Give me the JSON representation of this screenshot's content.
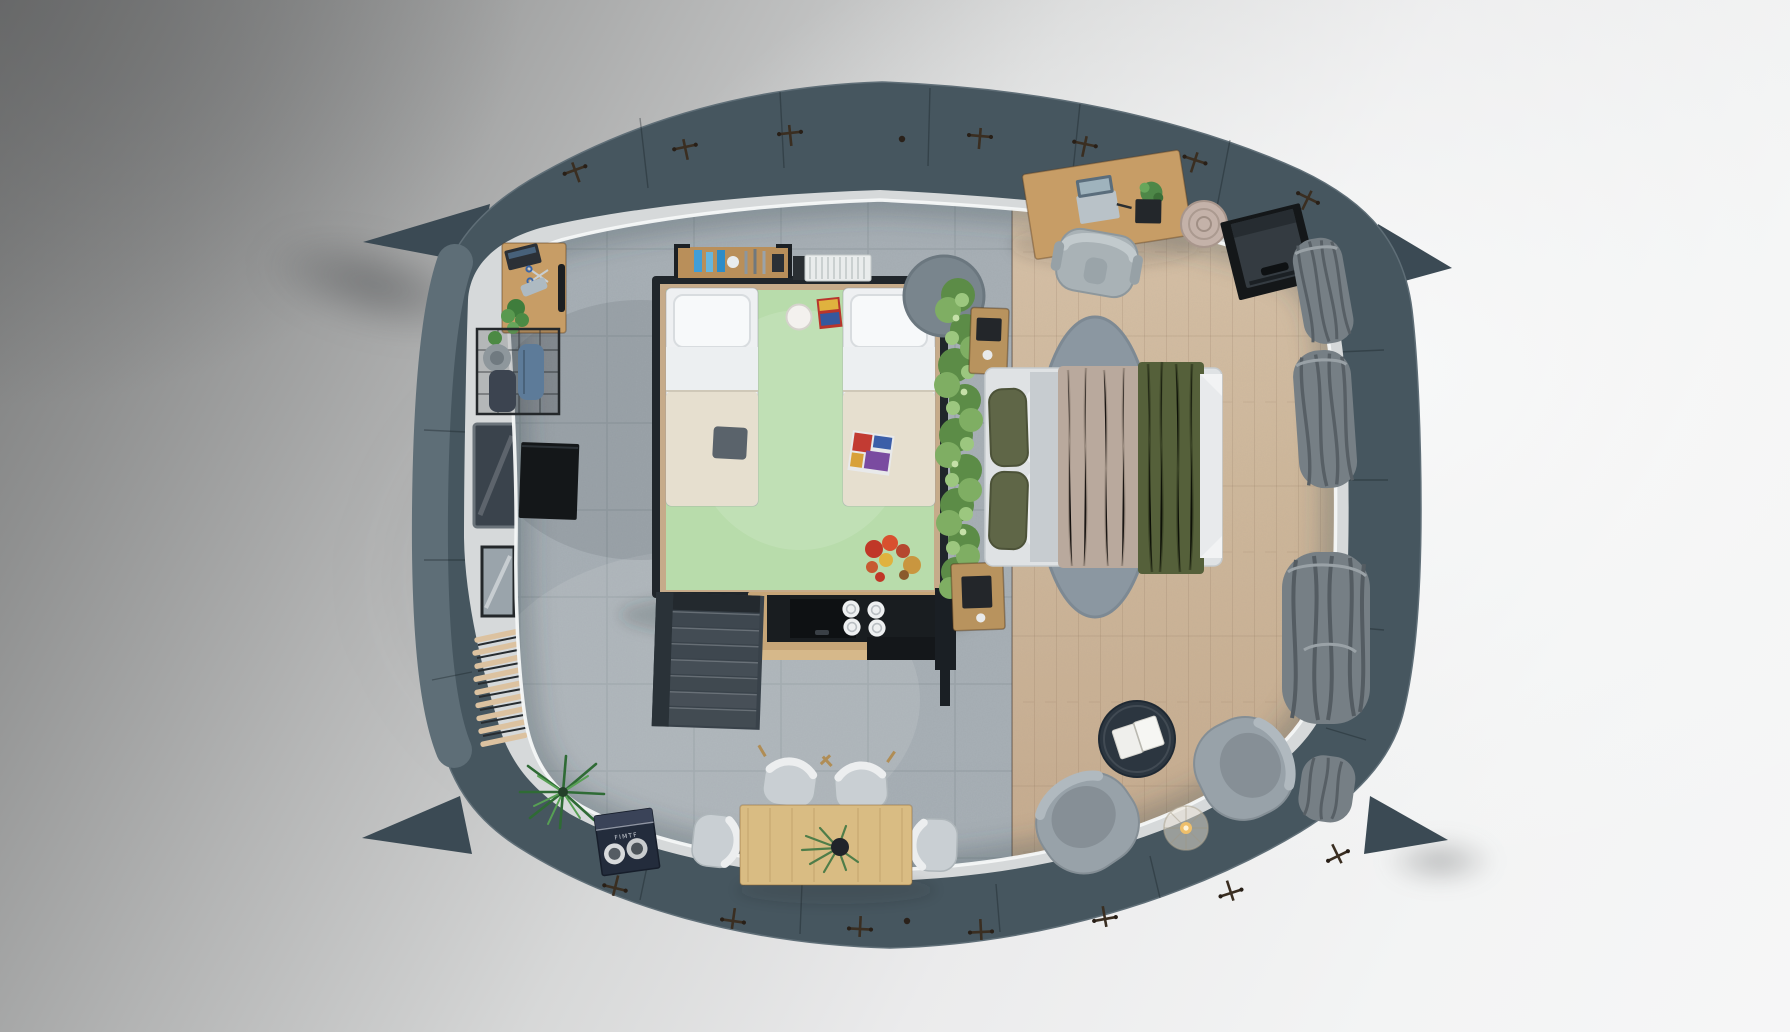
{
  "meta": {
    "title": "Top-down 3D render of a rounded pod tiny-home interior floor plan",
    "view": "top-down orthographic",
    "render_style": "photorealistic architectural visualization"
  },
  "palette": {
    "shell": "#46565f",
    "shellDark": "#3b4a54",
    "shellMid": "#5e6e77",
    "trimWhite": "#f2f4f4",
    "innerPanel": "#d6d9da",
    "tileFloor": "#a8b0b6",
    "woodFloor": "#cfb89b",
    "greenMat": "#b8dcab",
    "loftFrame": "#20262b",
    "hedgeGreen": "#7fae63",
    "bedWhite": "#eef0f2",
    "blanketCream": "#e6dfcf",
    "duvetTaupe": "#b9a99d",
    "throwOlive": "#55603a",
    "pillowOlive": "#5f6647",
    "rugGray": "#8b97a1",
    "kitchenBlack": "#191d20",
    "counterWood": "#c7a678",
    "stairGray": "#39424a",
    "tableOak": "#d9bc83",
    "chairShell": "#c9cfd3",
    "armchairGray": "#98a2a9",
    "coffeeTableNavy": "#2c3640",
    "curtainGray": "#767f85",
    "deskOak": "#c79d66",
    "tvBlack": "#141719",
    "basketTan": "#c4b2a9",
    "boxNavy": "#232c3c",
    "plantGreen": "#4c8a44",
    "backgroundLight": "#f3f4f4",
    "backgroundShadow": "#757676"
  },
  "labels": {
    "game_box_text": "FIMTF"
  },
  "scene": {
    "rooms": [
      {
        "id": "kids-loft",
        "label": "Kids loft bedroom with twin beds on green mat"
      },
      {
        "id": "master-bedroom",
        "label": "Master bedroom with double bed on wood floor"
      },
      {
        "id": "kitchenette",
        "label": "Kitchenette under loft with cooktop and plates"
      },
      {
        "id": "dining-area",
        "label": "Dining area with oak table and four chairs"
      },
      {
        "id": "lounge",
        "label": "Lounge with two armchairs and round coffee table"
      },
      {
        "id": "office-nook",
        "label": "Desk workspace along the top-right wall"
      }
    ],
    "items": [
      {
        "id": "pod-shell",
        "label": "Curved slate-blue pod shell with fastener cross markers and corner fins"
      },
      {
        "id": "twin-bed-left",
        "label": "Twin bed, white pillow, cream blanket, gray tablet"
      },
      {
        "id": "twin-bed-right",
        "label": "Twin bed, white pillow, cream blanket, comic book"
      },
      {
        "id": "ball-lamp",
        "label": "Round white floor lamp"
      },
      {
        "id": "toy-cluster",
        "label": "Red and orange toys on green mat"
      },
      {
        "id": "hedge-divider",
        "label": "Green plant hedge room divider"
      },
      {
        "id": "double-bed",
        "label": "Double bed with olive pillows, taupe duvet and olive throw"
      },
      {
        "id": "bed-rug",
        "label": "Oval blue-gray rug under double bed"
      },
      {
        "id": "kitchen-counter",
        "label": "Kitchen counter with black cooktop and four plates"
      },
      {
        "id": "stairs",
        "label": "Dark gray staircase to loft"
      },
      {
        "id": "dining-table",
        "label": "Light oak dining table with potted plant"
      },
      {
        "id": "dining-chairs",
        "label": "Four molded shell dining chairs"
      },
      {
        "id": "armchairs",
        "label": "Two gray lounge armchairs"
      },
      {
        "id": "coffee-table",
        "label": "Round navy coffee table with open book"
      },
      {
        "id": "floor-lamp",
        "label": "Translucent cone lamp with warm bulb"
      },
      {
        "id": "office-desk",
        "label": "Oak desk with laptop, notebook and plant"
      },
      {
        "id": "office-chair",
        "label": "Gray swivel office chair"
      },
      {
        "id": "tv-console",
        "label": "Black TV screen on dark floor stand"
      },
      {
        "id": "basket-pouf",
        "label": "Round woven basket pouf"
      },
      {
        "id": "curtains",
        "label": "Gray curtain bundles along the right glass wall"
      },
      {
        "id": "desk-top-left",
        "label": "Small wall desk with laptop, scissors, phone and plant"
      },
      {
        "id": "wire-rack",
        "label": "Black wire storage rack with hat and bags"
      },
      {
        "id": "floor-tv-panel",
        "label": "Flat black TV panel on floor"
      },
      {
        "id": "wall-window",
        "label": "Dark window opening in left wall"
      },
      {
        "id": "wall-mirror",
        "label": "Framed mirror on left wall"
      },
      {
        "id": "slat-vent",
        "label": "Diagonal wooden slat vent on left wall"
      },
      {
        "id": "palm-plant",
        "label": "Potted palm plant"
      },
      {
        "id": "game-box",
        "label": "Navy board game box with two medallions"
      },
      {
        "id": "loft-shelf",
        "label": "Shelf with blue bottles above loft"
      },
      {
        "id": "ac-unit",
        "label": "White ventilation grille unit"
      },
      {
        "id": "nightstands",
        "label": "Two small oak nightstands beside double bed"
      },
      {
        "id": "round-rug",
        "label": "Small round gray rug at loft corner"
      }
    ]
  }
}
